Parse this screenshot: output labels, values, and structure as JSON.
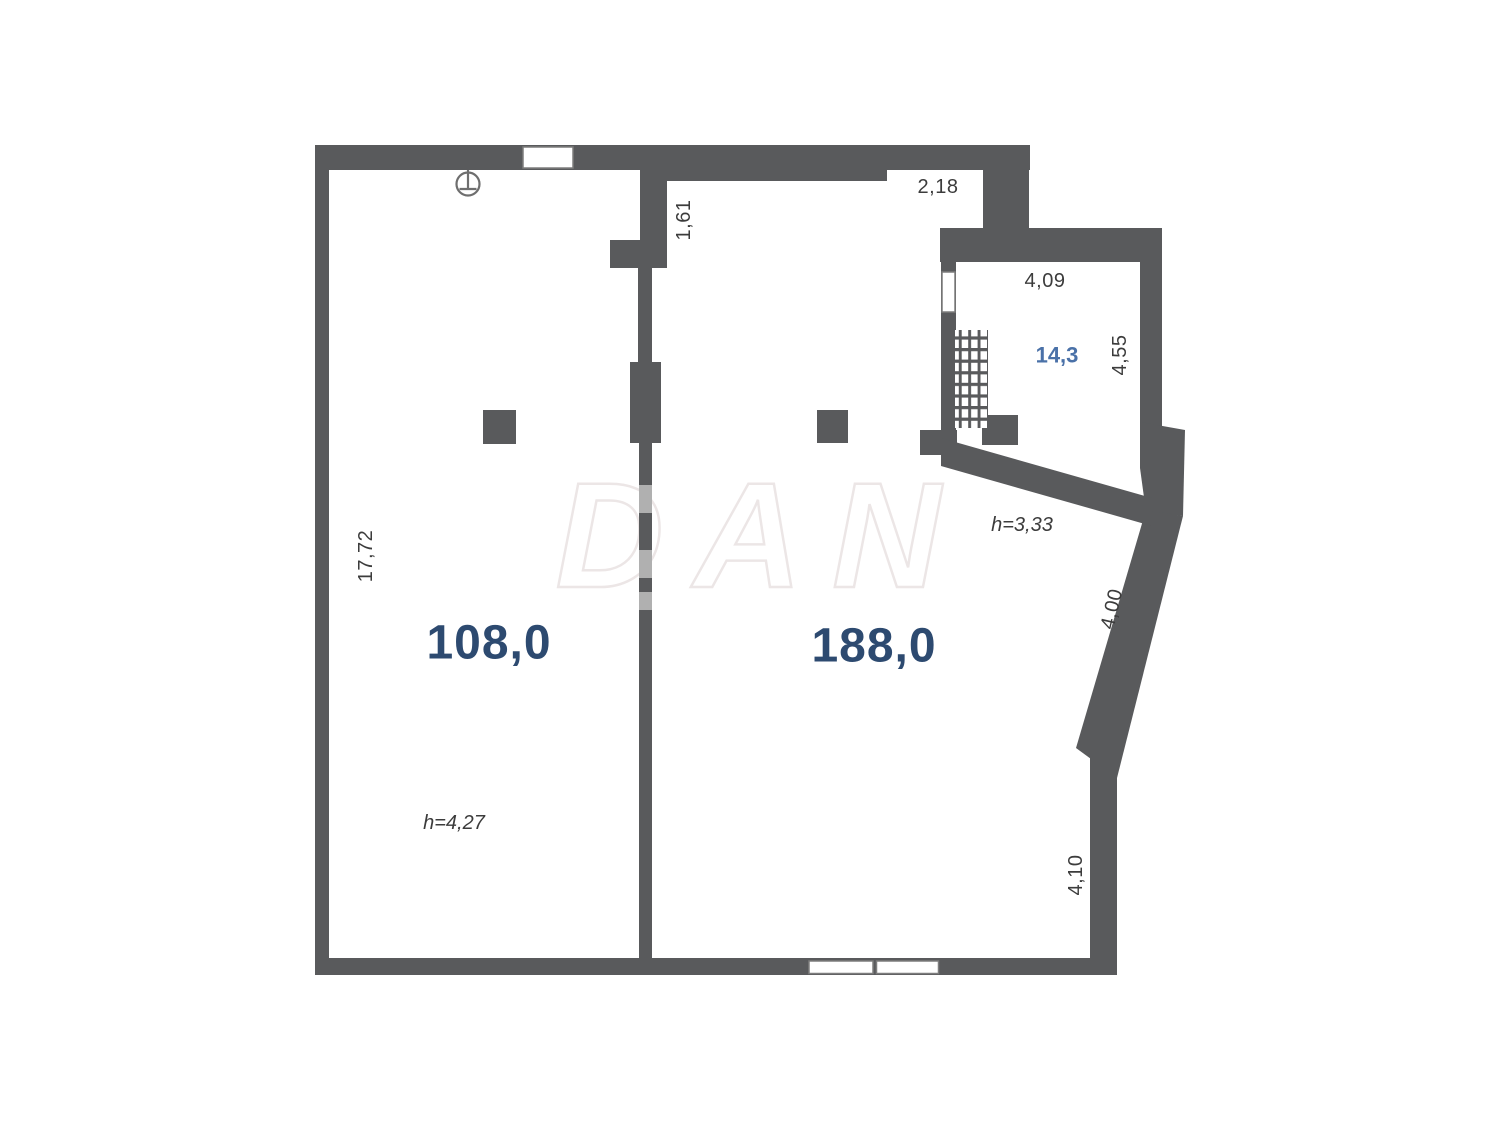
{
  "watermark": "DAN",
  "rooms": {
    "left": {
      "area": "108,0",
      "ceiling_height": "h=4,27"
    },
    "right": {
      "area": "188,0",
      "ceiling_height": "h=3,33"
    },
    "top_right": {
      "area": "14,3"
    }
  },
  "dimensions": {
    "left_wall": "17,72",
    "partition_opening": "1,61",
    "entry_recess": "2,18",
    "small_room_width": "4,09",
    "small_room_depth": "4,55",
    "slanted_wall": "4,00",
    "right_wall": "4,10"
  },
  "colors": {
    "wall": "#595a5c",
    "wall_light": "#b0b0b0",
    "area_label": "#2d4a70",
    "small_area_label": "#4a71a8",
    "dim_label": "#3c3c3c",
    "watermark": "#ece6e6",
    "window_fill": "#ffffff",
    "window_stroke": "#7d7d7d",
    "symbol_stroke": "#6e6e6e"
  }
}
